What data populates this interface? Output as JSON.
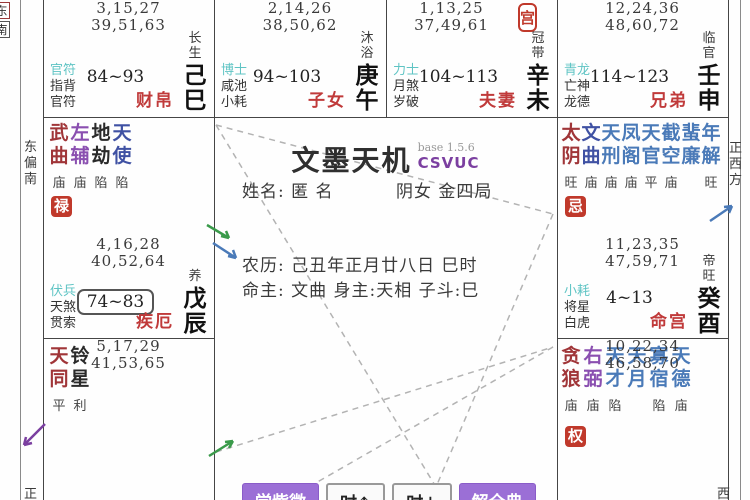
{
  "app": {
    "title": "文墨天机",
    "version_label": "base 1.5.6",
    "edition": "CSVUC"
  },
  "profile": {
    "name_line": "姓名: 匿 名",
    "gender_bureau": "阴女 金四局",
    "lunar_line": "农历: 己丑年正月廿八日 巳时",
    "master_line": "命主: 文曲 身主:天相 子斗:巳"
  },
  "buttons": {
    "learn": "学紫微",
    "hour_up": "时↑",
    "hour_down": "时↓",
    "dictionary": "解全典"
  },
  "margins": {
    "left_direction": "东偏南",
    "left_bottom": "正",
    "right_direction": "正西方",
    "right_bottom": "西",
    "corner_box_1": "东",
    "corner_box_2": "南"
  },
  "body_palace_badge": "宫",
  "colors": {
    "accent_purple": "#9b6fd6",
    "badge_red": "#c0392b",
    "palace_name_red": "#c03a3a",
    "god_teal": "#5fc4c4",
    "star_major_red": "#a03538",
    "star_assist_purple": "#8a4fb0",
    "star_navy_blue": "#3f51a3",
    "star_minor_blue": "#4a7ab8",
    "edition_purple": "#7b3fa0"
  },
  "palaces": [
    {
      "ages1": "3,15,27",
      "ages2": "39,51,63",
      "stage": "长生",
      "ganzhi": "己巳",
      "gods": [
        "官符",
        "指背",
        "官符"
      ],
      "decade": "84~93",
      "name": "财帛"
    },
    {
      "ages1": "2,14,26",
      "ages2": "38,50,62",
      "stage": "沐浴",
      "ganzhi": "庚午",
      "gods": [
        "博士",
        "咸池",
        "小耗"
      ],
      "decade": "94~103",
      "name": "子女"
    },
    {
      "ages1": "1,13,25",
      "ages2": "37,49,61",
      "stage": "冠带",
      "ganzhi": "辛未",
      "gods": [
        "力士",
        "月煞",
        "岁破"
      ],
      "decade": "104~113",
      "name": "夫妻"
    },
    {
      "ages1": "12,24,36",
      "ages2": "48,60,72",
      "stage": "临官",
      "ganzhi": "壬申",
      "gods": [
        "青龙",
        "亡神",
        "龙德"
      ],
      "decade": "114~123",
      "name": "兄弟"
    },
    {
      "ages1": "4,16,28",
      "ages2": "40,52,64",
      "stage": "养",
      "ganzhi": "戊辰",
      "gods": [
        "伏兵",
        "天煞",
        "贯索"
      ],
      "decade": "74~83",
      "name": "疾厄",
      "hua": "禄",
      "stars": [
        {
          "name": "武曲",
          "grade": "庙"
        },
        {
          "name": "左辅",
          "grade": "庙"
        },
        {
          "name": "地劫",
          "grade": "陷"
        },
        {
          "name": "天使",
          "grade": "陷"
        }
      ]
    },
    {
      "ages1": "5,17,29",
      "ages2": "41,53,65",
      "stars": [
        {
          "name": "天同",
          "grade": "平"
        },
        {
          "name": "铃星",
          "grade": "利"
        }
      ]
    },
    {
      "ages1": "11,23,35",
      "ages2": "47,59,71",
      "stage": "帝旺",
      "ganzhi": "癸酉",
      "gods": [
        "小耗",
        "将星",
        "白虎"
      ],
      "decade": "4~13",
      "name": "命宫",
      "hua": "忌",
      "stars": [
        {
          "name": "太阴",
          "grade": "旺"
        },
        {
          "name": "文曲",
          "grade": "庙"
        },
        {
          "name": "天刑",
          "grade": "庙"
        },
        {
          "name": "凤阁",
          "grade": "庙"
        },
        {
          "name": "天官",
          "grade": "平"
        },
        {
          "name": "截空",
          "grade": "庙"
        },
        {
          "name": "蜚廉",
          "grade": ""
        },
        {
          "name": "年解",
          "grade": "旺"
        }
      ]
    },
    {
      "ages1": "10,22,34",
      "ages2": "46,58,70",
      "hua": "权",
      "stars": [
        {
          "name": "贪狼",
          "grade": "庙"
        },
        {
          "name": "右弼",
          "grade": "庙"
        },
        {
          "name": "天才",
          "grade": "陷"
        },
        {
          "name": "天月",
          "grade": ""
        },
        {
          "name": "寡宿",
          "grade": "陷"
        },
        {
          "name": "天德",
          "grade": "庙"
        }
      ]
    }
  ]
}
